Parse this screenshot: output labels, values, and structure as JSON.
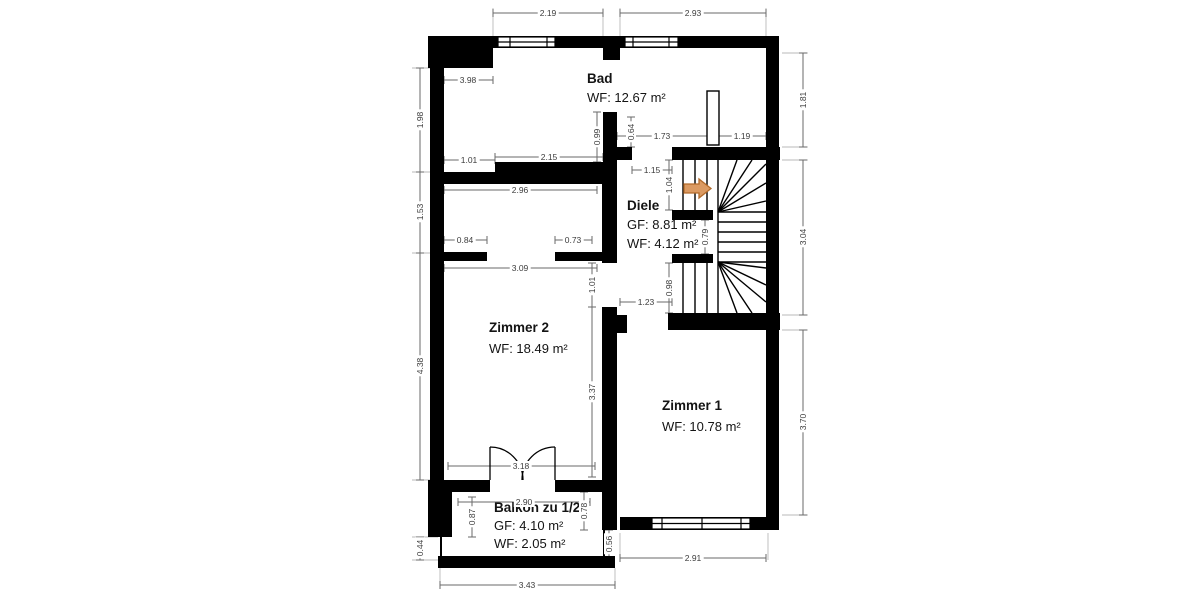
{
  "plan": {
    "rooms": {
      "bad": {
        "name": "Bad",
        "wf": "WF: 12.67 m²"
      },
      "diele": {
        "name": "Diele",
        "gf": "GF: 8.81 m²",
        "wf": "WF: 4.12 m²"
      },
      "zimmer2": {
        "name": "Zimmer 2",
        "wf": "WF: 18.49 m²"
      },
      "zimmer1": {
        "name": "Zimmer 1",
        "wf": "WF: 10.78 m²"
      },
      "balkon": {
        "name": "Balkon zu 1/2",
        "gf": "GF: 4.10 m²",
        "wf": "WF: 2.05 m²"
      }
    },
    "dims": {
      "top_left": "2.19",
      "top_right": "2.93",
      "bad_width": "3.98",
      "bad_door": "1.01",
      "bad_wall": "2.15",
      "bad_east_upper": "0.99",
      "bad_east_lower": "0.64",
      "bad_chimney_left": "1.73",
      "chimney_right": "1.19",
      "diele_opening": "1.15",
      "stair_upper": "1.04",
      "stair_mid": "0.79",
      "stair_lower": "0.98",
      "zimmer1_door": "1.23",
      "alcove_width": "2.96",
      "stub_left": "0.84",
      "stub_right": "0.73",
      "zimmer2_width": "3.09",
      "zimmer2_door": "1.01",
      "zimmer2_east": "3.37",
      "zimmer2_south": "3.18",
      "balkon_width": "2.90",
      "balkon_left": "0.87",
      "balkon_right": "0.78",
      "balkon_edge_right": "0.56",
      "balkon_edge_left": "0.44",
      "left_upper": "1.98",
      "left_mid": "1.53",
      "left_lower": "4.38",
      "right_upper": "1.81",
      "right_mid": "3.04",
      "right_lower": "3.70",
      "bottom_zimmer1": "2.91",
      "bottom_balkon": "3.43"
    },
    "stair_arrow": {
      "direction": "right",
      "fill": "#DB9A62",
      "stroke": "#B36B2B"
    },
    "colors": {
      "wall": "#000000",
      "dim_line": "#6a6a6a",
      "dim_text": "#3c3c3c",
      "room_text": "#141414",
      "background": "#ffffff"
    }
  }
}
